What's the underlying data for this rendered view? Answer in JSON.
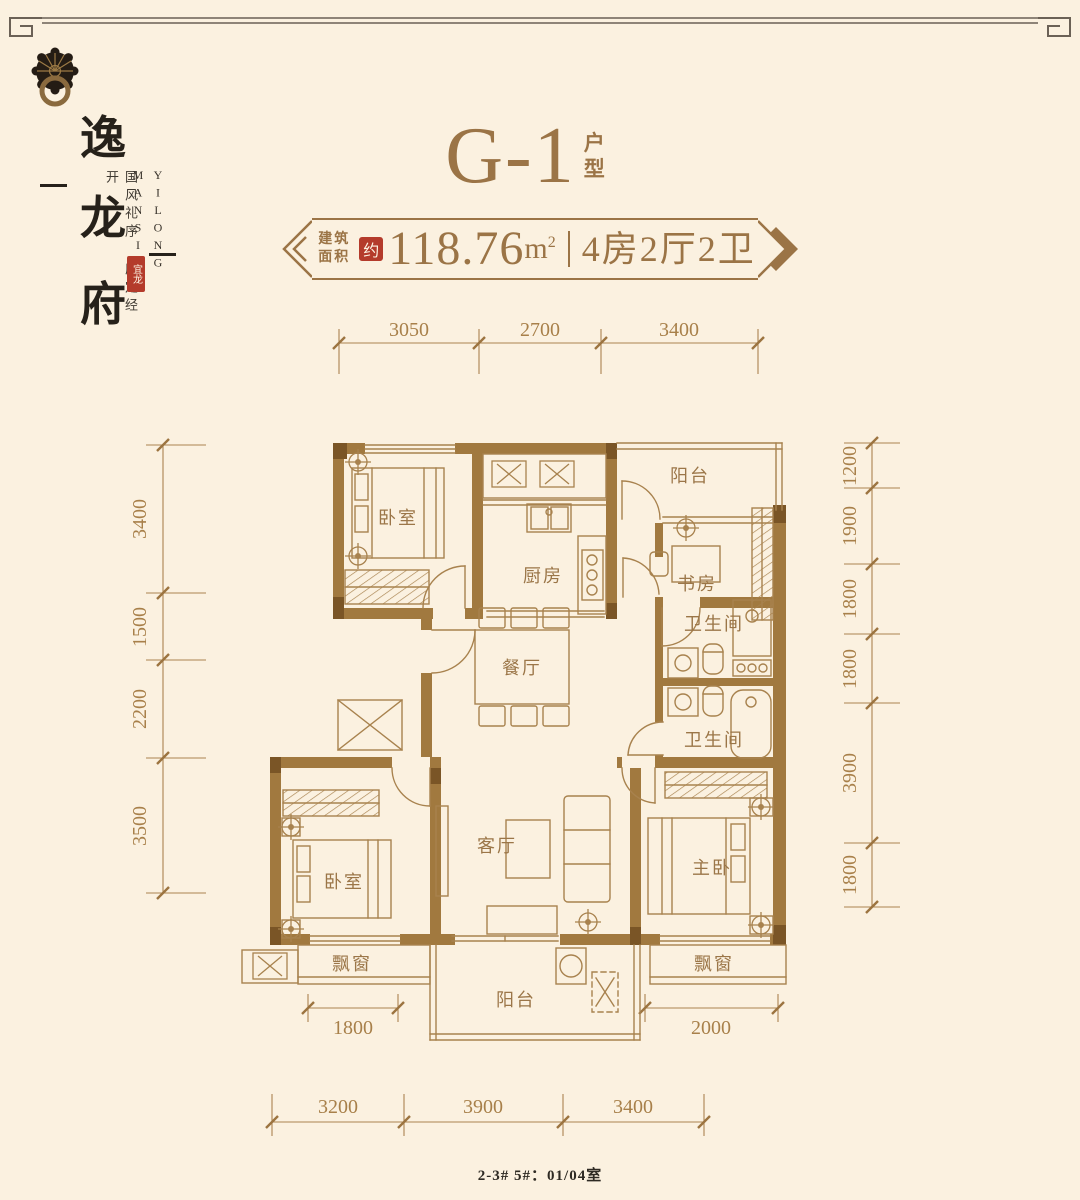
{
  "colors": {
    "background": "#fbf1e0",
    "bronze": "#9b7446",
    "plan_line": "#a8824e",
    "wall_fill": "#a1793f",
    "wall_dark": "#7a5526",
    "ink": "#26211a",
    "seal_red": "#b43b2b"
  },
  "brand": {
    "logo_icon": "door-knocker-icon",
    "chars": [
      "逸",
      "龙",
      "府"
    ],
    "tagline": "国风礼序 府定经开",
    "english": [
      "YILONG",
      "MANSION"
    ],
    "seal": "宜龙"
  },
  "title": {
    "main": "G-1",
    "suffix_chars": [
      "户",
      "型"
    ]
  },
  "banner": {
    "prefix": [
      "建筑",
      "面积"
    ],
    "approx_seal": "约",
    "area": "118.76",
    "unit": "m",
    "unit_exp": "2",
    "spec": "4房2厅2卫"
  },
  "plan": {
    "rooms": {
      "bedroom_top": "卧室",
      "kitchen": "厨房",
      "balcony_top": "阳台",
      "study": "书房",
      "bath_top": "卫生间",
      "bath_bottom": "卫生间",
      "dining": "餐厅",
      "living": "客厅",
      "bedroom_bottom": "卧室",
      "master": "主卧",
      "bay_left": "飘窗",
      "balcony_bottom": "阳台",
      "bay_right": "飘窗"
    },
    "dims": {
      "top": [
        "3050",
        "2700",
        "3400"
      ],
      "bottom": [
        "3200",
        "3900",
        "3400"
      ],
      "left": [
        "3400",
        "1500",
        "2200",
        "3500"
      ],
      "right": [
        "1200",
        "1900",
        "1800",
        "1800",
        "3900",
        "1800"
      ],
      "inner_bay_left": "1800",
      "inner_bay_right": "2000"
    }
  },
  "footer": {
    "note": "2-3# 5#：01/04室"
  }
}
